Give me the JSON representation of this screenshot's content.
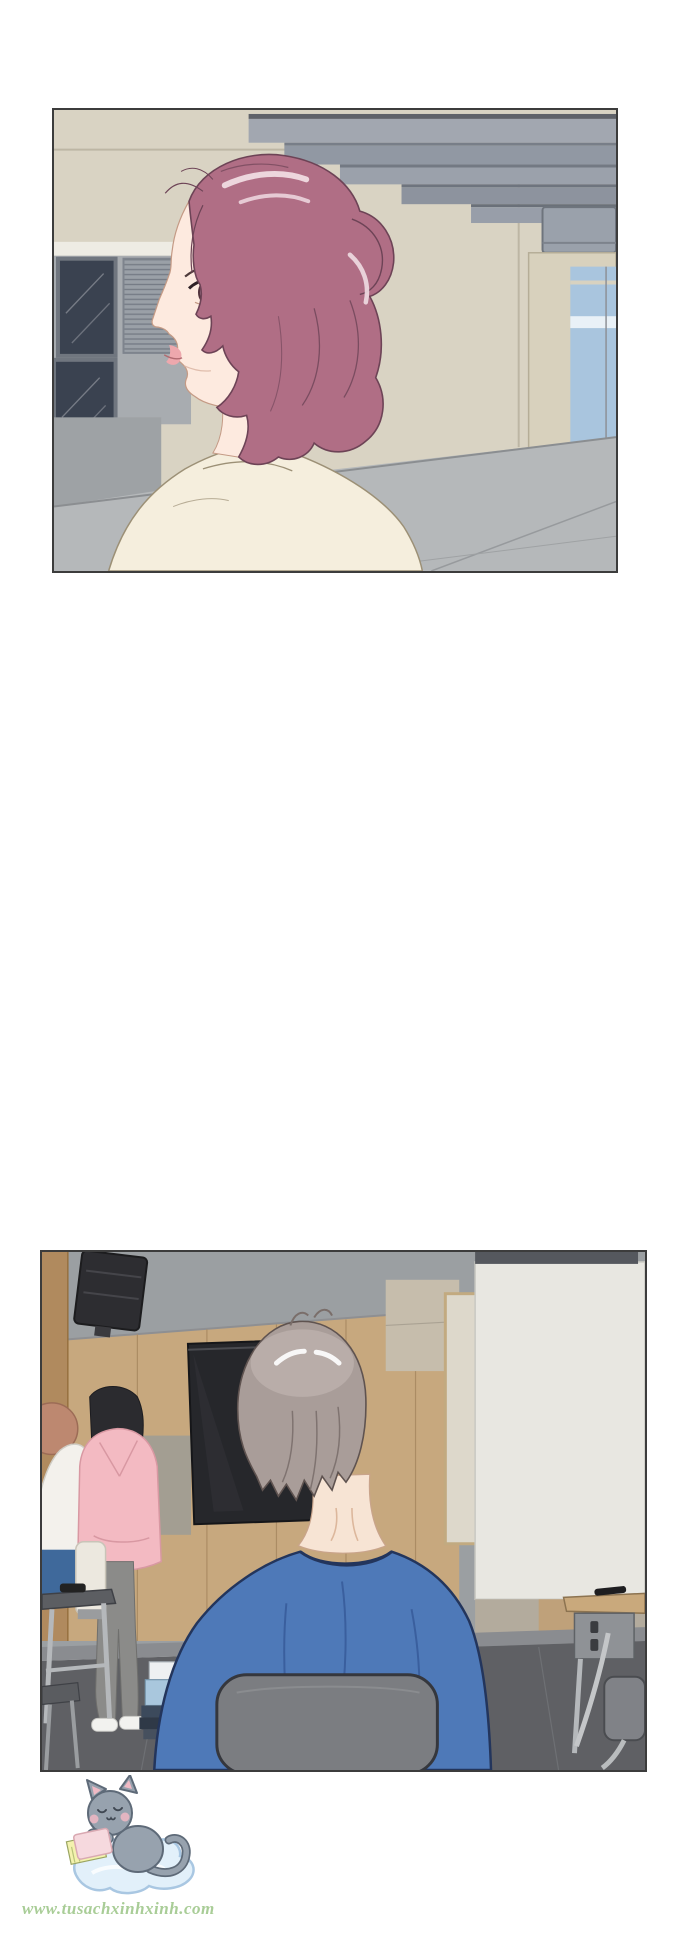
{
  "page_type": "webtoon comic page",
  "watermark": {
    "url_text": "www.tusachxinhxinh.com",
    "mascot": "gray kitten reading a pink book while sitting on a blue cloud"
  },
  "panels": {
    "panel1": {
      "alt": "Profile view of a smiling woman with mauve pink hair tied back in a low bun, wearing a cream top, standing outside a beige building with dark windows, a louvered vent, layered gray awnings and a blue glass door"
    },
    "panel2": {
      "alt": "Classroom seen from behind a gray-haired man in a blue shirt sitting on a gray chair; a girl in a pink hoodie and another person stand by a wood-panel wall near a wall TV, a large white projection screen hangs at the right, desks and chairs around"
    }
  },
  "colors": {
    "page_bg": "#ffffff",
    "panel_border": "#3c3c3c",
    "building_wall": "#d9d3c3",
    "white_band": "#eeece4",
    "gray_section": "#a8acb0",
    "lower_wall_gray": "#9ea2a5",
    "window_dark": "#3a4250",
    "window_frame": "#70767f",
    "louver_gray": "#9aa0a7",
    "awning_gray": "#a2a7b0",
    "awning_dark": "#6b7079",
    "door_frame": "#d8d1bd",
    "door_glass": "#a9c5de",
    "pavement": "#b5b8ba",
    "wall_seam": "#bdb6a4",
    "hair_mauve": "#b06e85",
    "hair_line": "#6d4356",
    "hair_highlight": "#f0dbe2",
    "skin": "#fdeadf",
    "skin_line": "#c49a85",
    "lips": "#eda8ad",
    "top_cream": "#f5eedd",
    "cream_line": "#9c9076",
    "class_wall_gray": "#9b9fa2",
    "wood_wall": "#c7a87e",
    "wood_dark": "#b08a5e",
    "speaker_black": "#2d2d31",
    "tv_dark": "#26272b",
    "screen_white": "#e8e7e1",
    "screen_top": "#55585e",
    "board_frame_tan": "#c2aa80",
    "man_hair": "#a99d99",
    "man_hair_light": "#cbc1bd",
    "man_skin": "#f7e4d4",
    "shirt_blue": "#4e79b8",
    "shirt_line": "#23355c",
    "chair_gray": "#7b7d81",
    "hoodie_pink": "#f3bac2",
    "girl_hair": "#2b2b2f",
    "pants_gray": "#8b8b89",
    "jeans_blue": "#3f699b",
    "white_top": "#f3f1ec",
    "orange_hair": "#bd8870",
    "floor_dark": "#5f6064",
    "floor_light": "#8a8c90",
    "desk_metal": "#b5b8bb",
    "desk_top_dark": "#5c5e62",
    "desk_top_tan": "#c9a97c",
    "cat_gray": "#97a2ae",
    "cat_outline": "#5e6a78",
    "cat_pink": "#f0b9c4",
    "cloud_blue": "#e2f0fa",
    "cloud_outline": "#a9c7e2",
    "book_pink": "#f6d9de",
    "book_pages": "#f3f2ae",
    "watermark_green": "#a9cd97"
  }
}
